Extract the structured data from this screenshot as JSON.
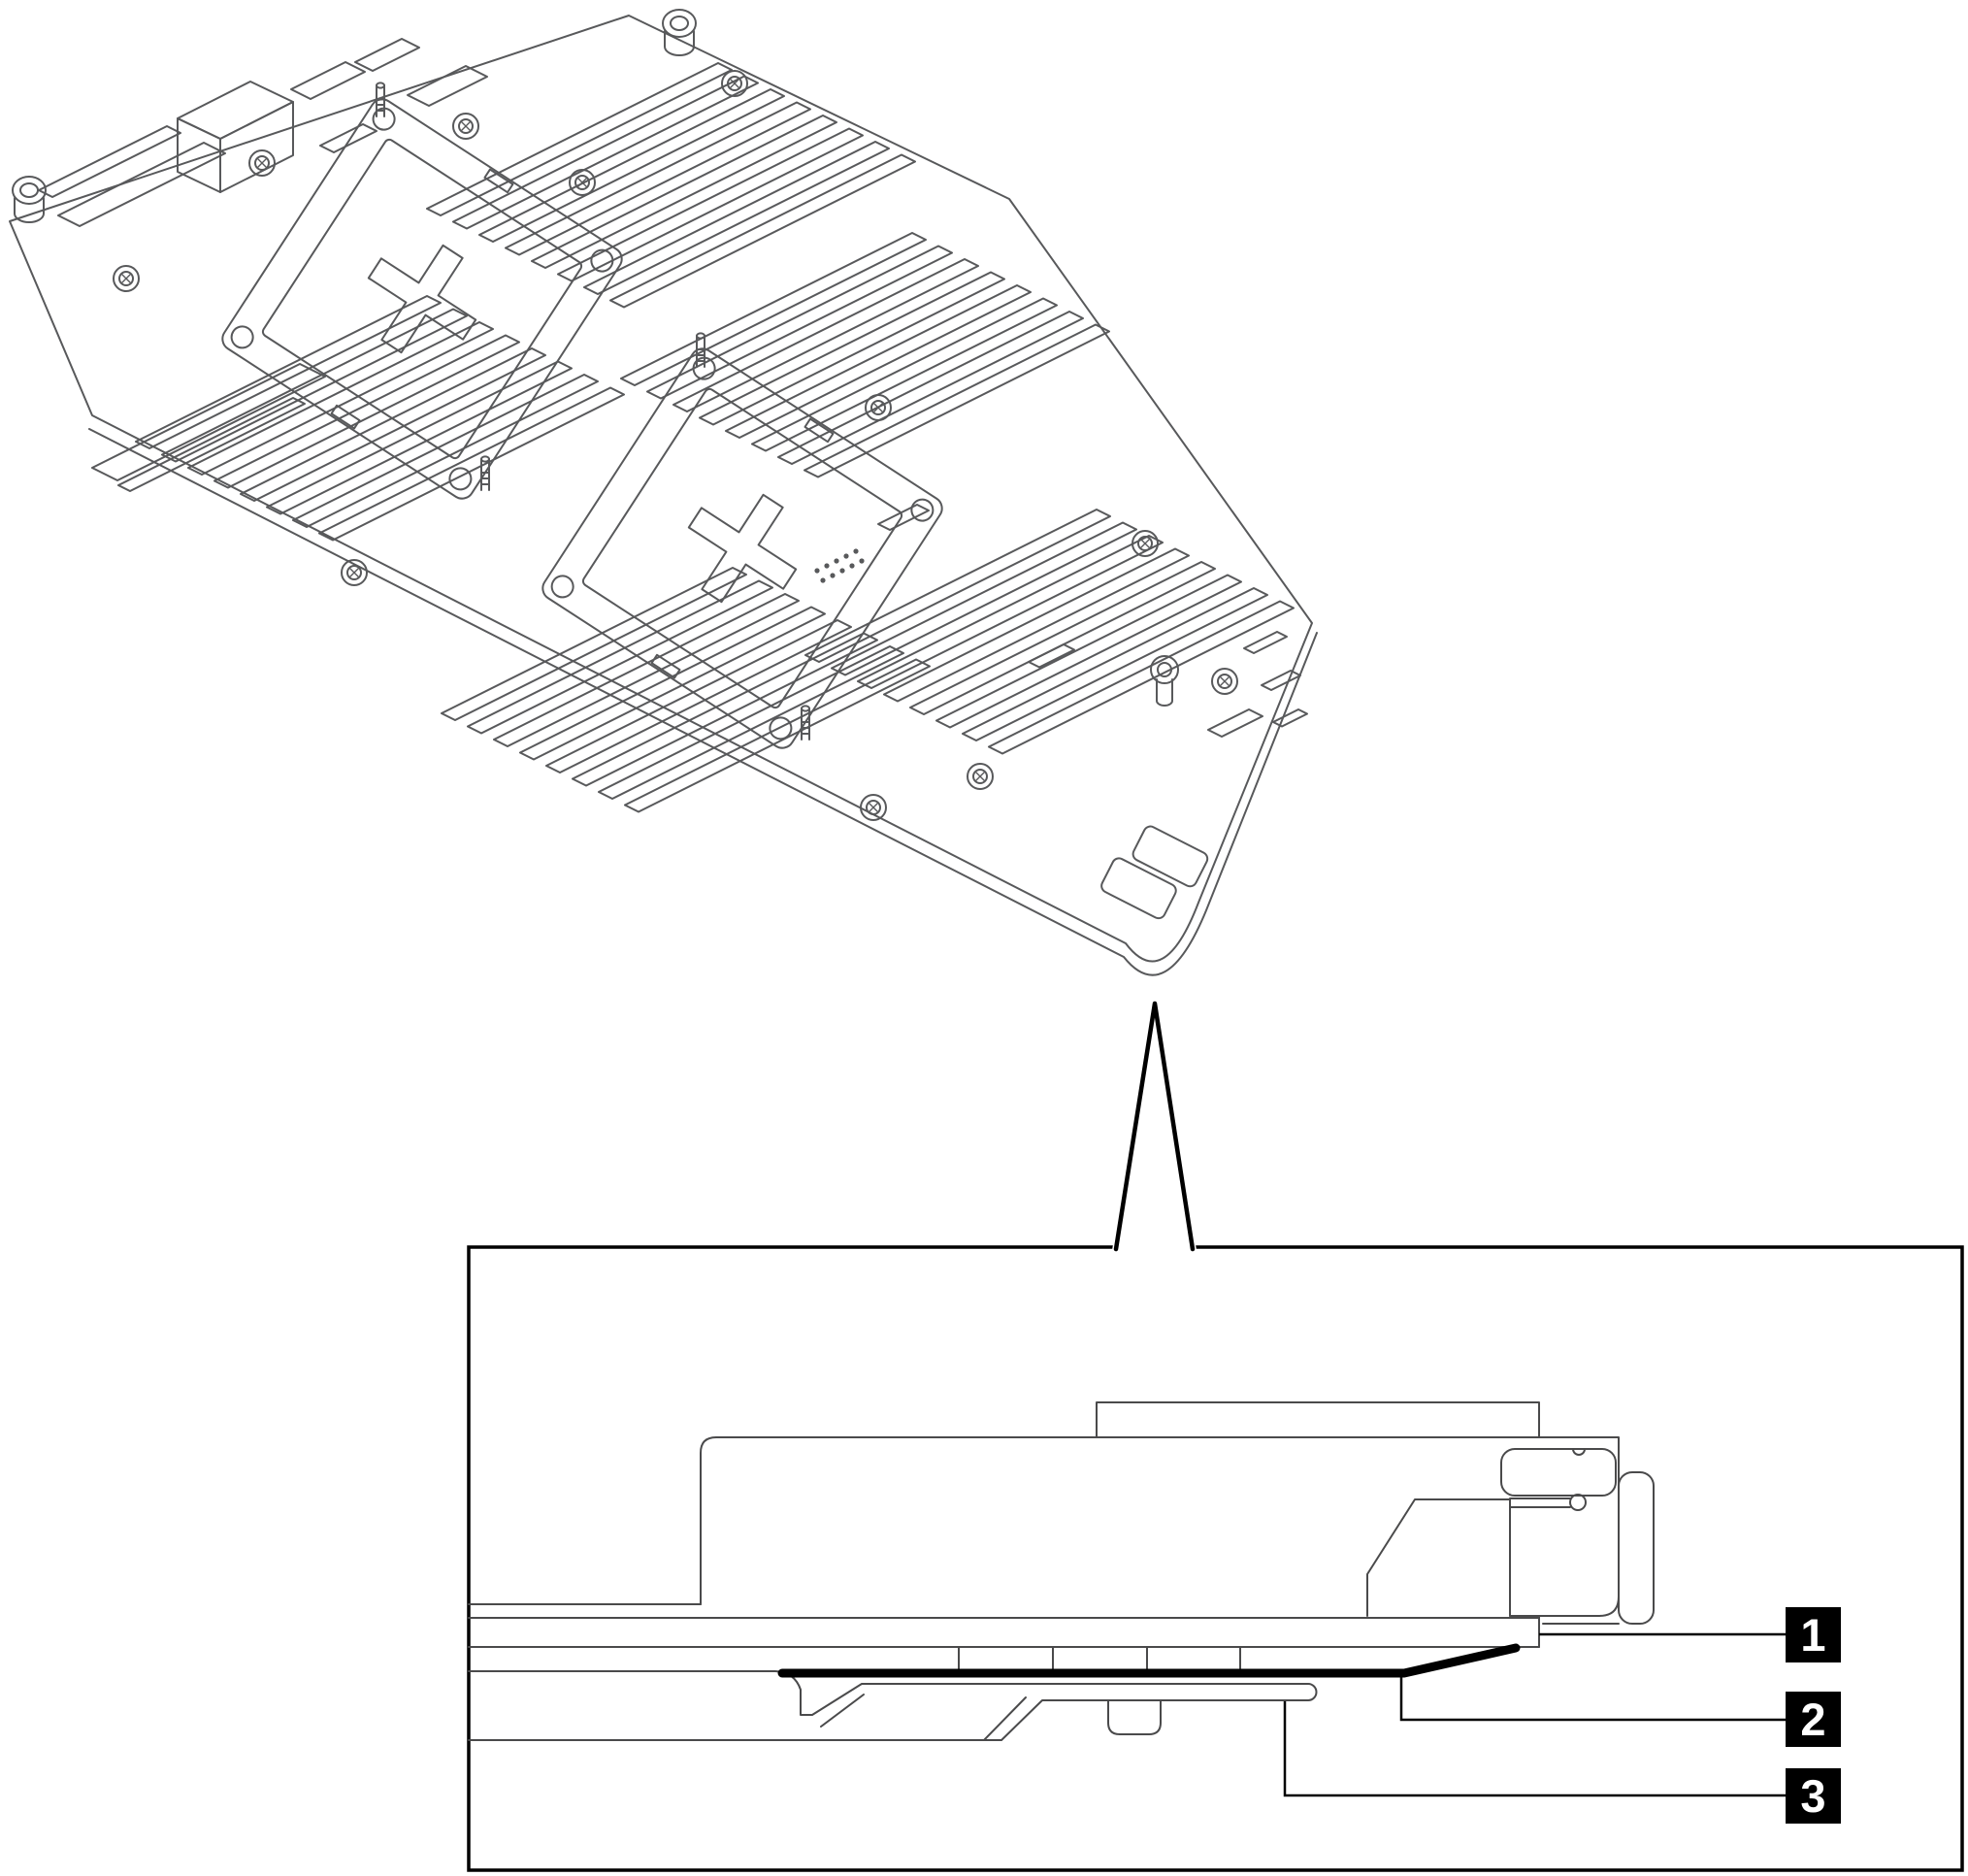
{
  "figure": {
    "kind": "technical-line-illustration",
    "subject": "server-system-board-with-edge-detail-callout",
    "background": "#ffffff",
    "colors": {
      "line": "#58595b",
      "detail_line": "#4a4a4b",
      "dark": "#000000",
      "badge_bg": "#000000",
      "badge_text": "#ffffff"
    }
  },
  "callouts": [
    {
      "label": "1"
    },
    {
      "label": "2"
    },
    {
      "label": "3"
    }
  ]
}
